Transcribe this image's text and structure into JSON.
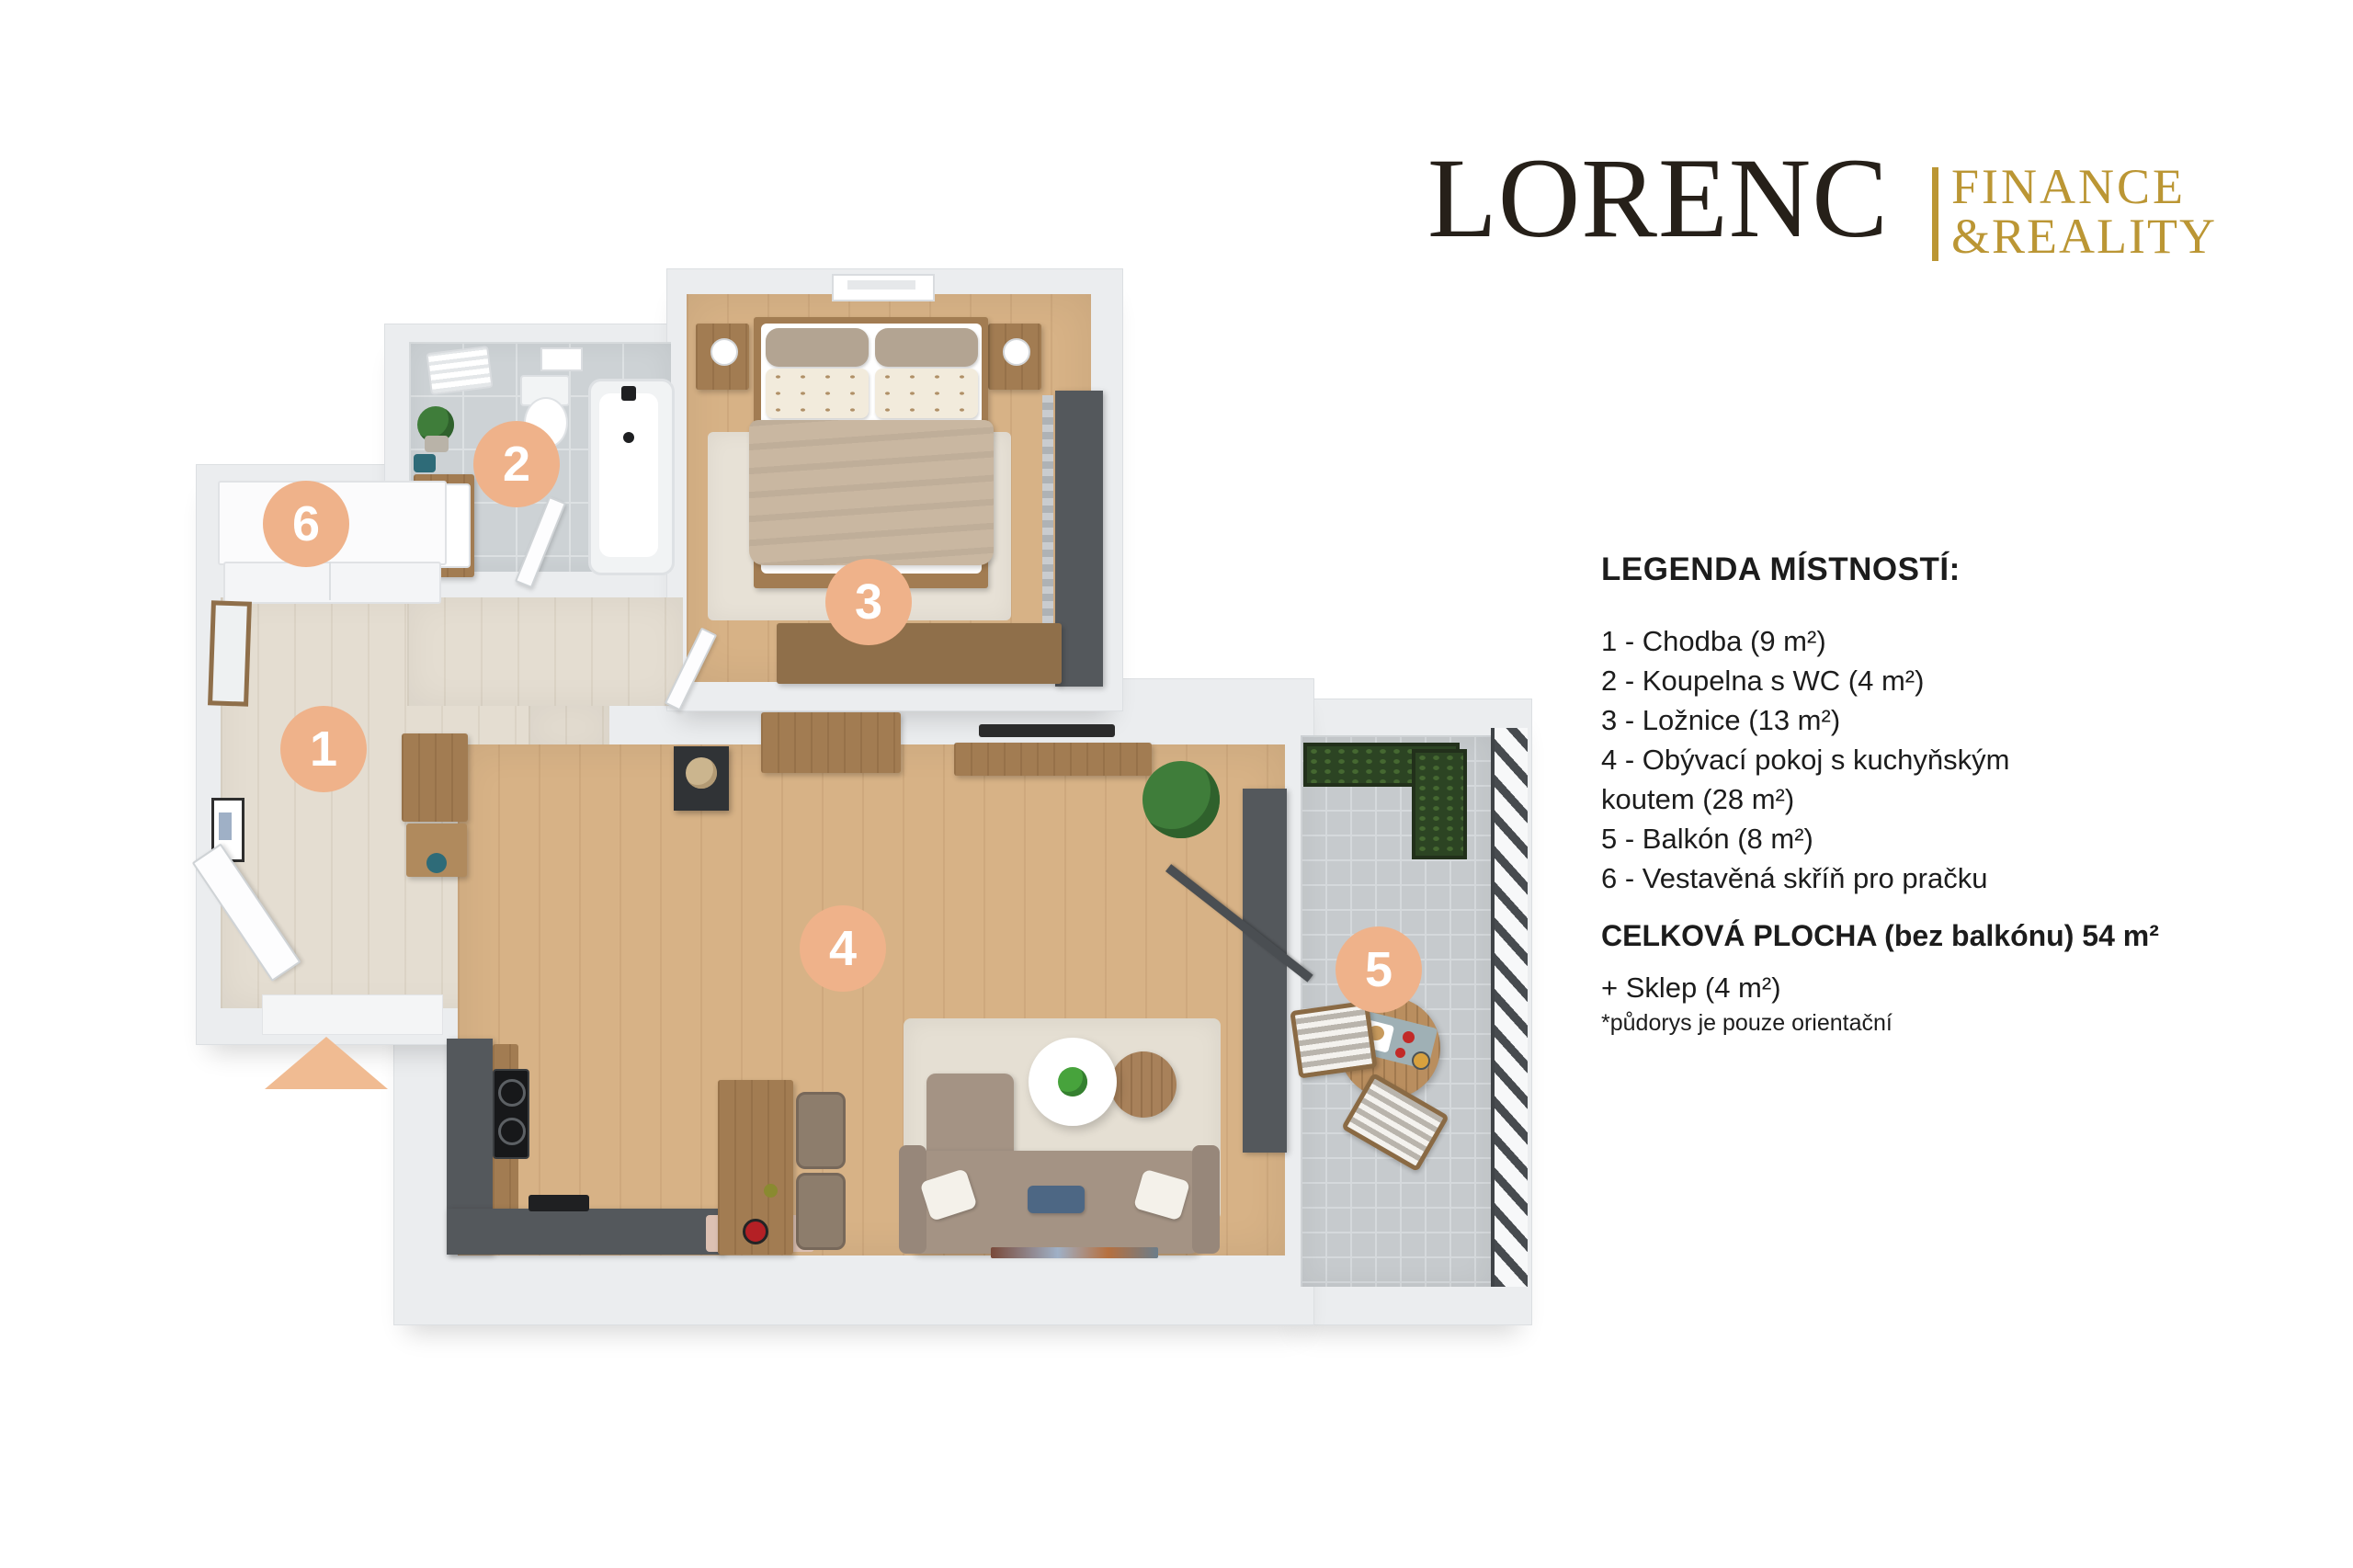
{
  "logo": {
    "brand": "LORENC",
    "division_line1": "FINANCE",
    "division_line2": "&REALITY",
    "brand_color": "#262019",
    "accent_color": "#bb9634"
  },
  "legend": {
    "title": "LEGENDA MÍSTNOSTÍ:",
    "lines": [
      "1 - Chodba (9 m²)",
      "2 - Koupelna s WC (4 m²)",
      "3 - Ložnice (13 m²)",
      "4 - Obývací pokoj s kuchyňským",
      "koutem (28 m²)",
      "5 - Balkón (8 m²)",
      "6 - Vestavěná skříň pro pračku"
    ],
    "total": "CELKOVÁ PLOCHA (bez balkónu) 54 m²",
    "extra": "+ Sklep (4 m²)",
    "note": "*půdorys je pouze orientační"
  },
  "floorplan": {
    "badges": [
      "1",
      "2",
      "3",
      "4",
      "5",
      "6"
    ],
    "badge_color": "#efb28a",
    "entry_arrow_color": "#f0bb92",
    "wall_color": "#ebedef",
    "wood_floor_color": "#d7b286",
    "pale_floor_color": "#e4ddd1",
    "tile_color": "#cdd2d5",
    "balcony_tile_color": "#c6cacd",
    "kitchen_unit_color": "#54585c"
  }
}
